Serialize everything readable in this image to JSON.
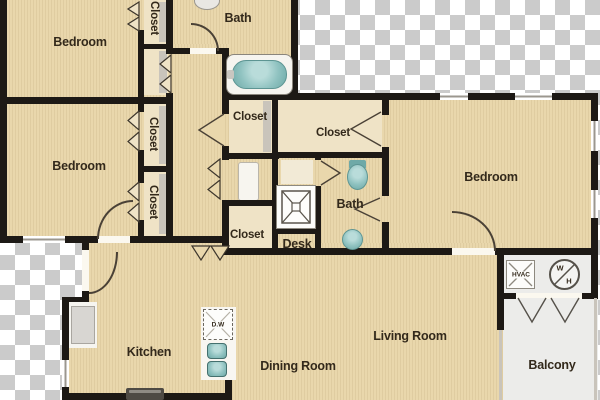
{
  "plan": {
    "labels": {
      "bedroom1": "Bedroom",
      "bedroom2": "Bedroom",
      "bedroom3": "Bedroom",
      "bath1": "Bath",
      "bath2": "Bath",
      "closet_top": "Closet",
      "closet_b": "Closet",
      "closet_c": "Closet",
      "closet_hall_upper": "Closet",
      "closet_hall_lower": "Closet",
      "closet_walkin": "Closet",
      "desk": "Desk",
      "kitchen": "Kitchen",
      "dining": "Dining Room",
      "living": "Living Room",
      "balcony": "Balcony",
      "hvac": "HVAC",
      "water_heater_w": "W",
      "water_heater_h": "H",
      "dishwasher": "D.W"
    },
    "fixtures": [
      "bathtub-icon",
      "toilet-icon",
      "sink-icon",
      "shower-icon",
      "stove-icon",
      "refrigerator-icon",
      "dishwasher-icon",
      "hvac-unit-icon",
      "water-heater-icon"
    ],
    "colors": {
      "wall": "#1d1915",
      "floor": "#e9d7ac",
      "closet": "#efe3c6",
      "balcony": "#ececea",
      "fixture": "#8fc2c0",
      "label": "#33291b",
      "checker": "#cbcbcb"
    }
  }
}
